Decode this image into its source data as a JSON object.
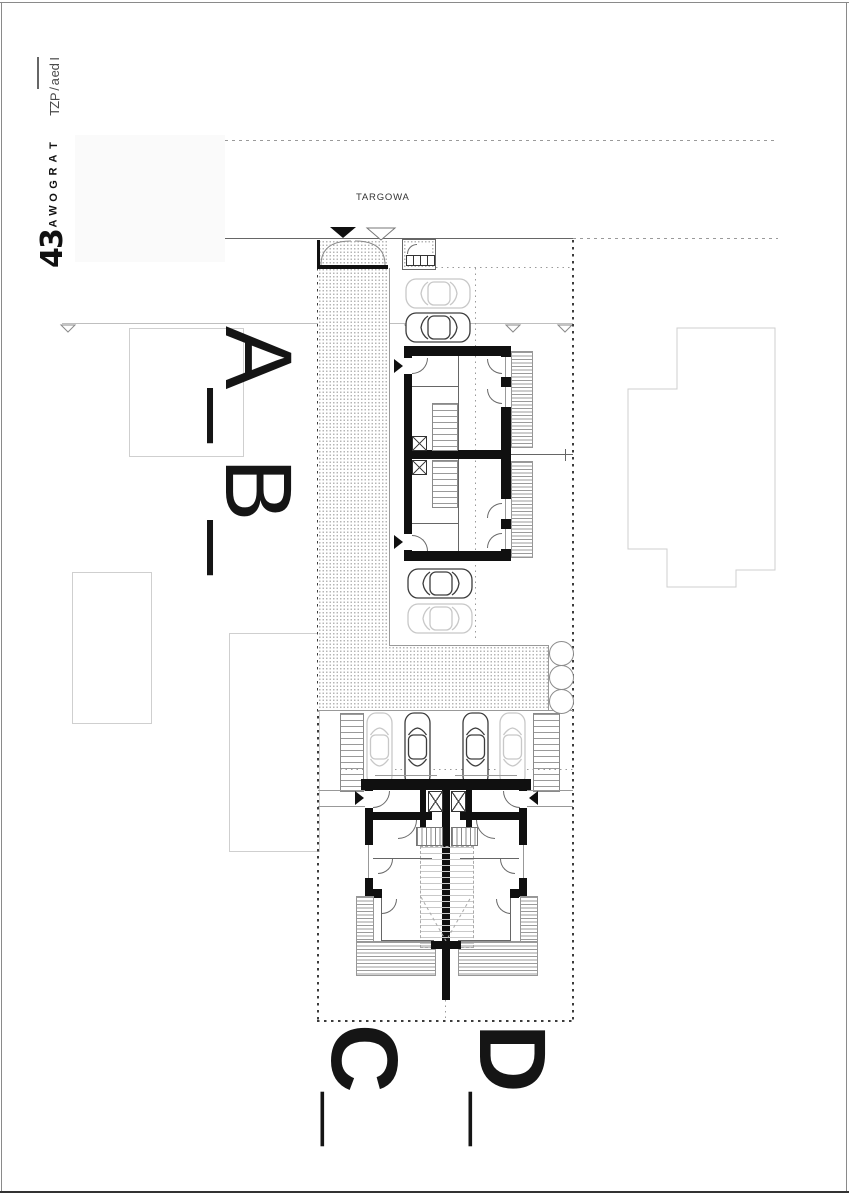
{
  "sidebar": {
    "project_label": "Idea/PZT",
    "street_name": "TARGOWA",
    "street_number": "34"
  },
  "plan": {
    "street_label": "TARGOWA",
    "section_markers": [
      {
        "id": "A",
        "label": "A_"
      },
      {
        "id": "B",
        "label": "B_"
      },
      {
        "id": "C",
        "label": "C_"
      },
      {
        "id": "D",
        "label": "D_"
      }
    ]
  },
  "icons": {
    "entrance_arrow_filled": "filled-triangle-icon",
    "entrance_arrow_open": "open-triangle-icon",
    "tree": "tree-circle-icon"
  },
  "colors": {
    "ink": "#101010",
    "line_gray": "#999999",
    "boundary": "#3c3c3c",
    "neighbor_outline": "#cfcfcf",
    "hatch_dot": "#b4b4b4",
    "car_dark": "#3d3d3d",
    "car_light": "#c8c8c8",
    "paper": "#ffffff"
  }
}
